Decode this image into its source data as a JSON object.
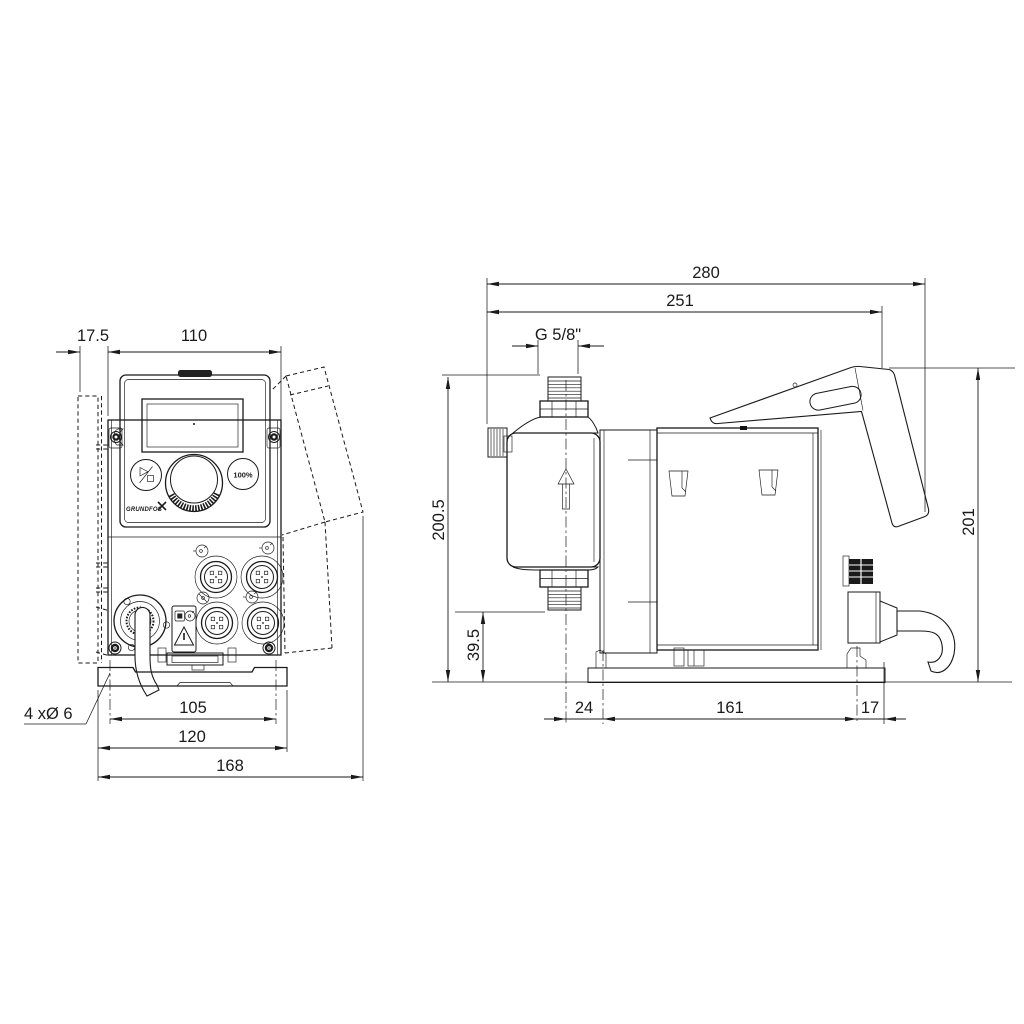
{
  "drawing": {
    "type": "technical-dimensional-drawing",
    "views": [
      "front",
      "side"
    ],
    "line_color": "#1a1a1a",
    "background": "#ffffff"
  },
  "front_view": {
    "dim_bracket_offset": "17.5",
    "dim_panel_width": "110",
    "dim_hole_spacing": "105",
    "dim_plate_width": "120",
    "dim_overall_width": "168",
    "label_mounting_holes": "4 xØ 6",
    "button_100": "100%",
    "logo": "GRUNDFOS"
  },
  "side_view": {
    "dim_overall_length": "280",
    "dim_length_to_cover_edge": "251",
    "dim_thread": "G 5/8\"",
    "dim_height_total": "200.5",
    "dim_height_suction_valve": "39.5",
    "dim_base_front": "24",
    "dim_base_hole_spacing": "161",
    "dim_base_rear": "17",
    "dim_overall_height": "201"
  }
}
